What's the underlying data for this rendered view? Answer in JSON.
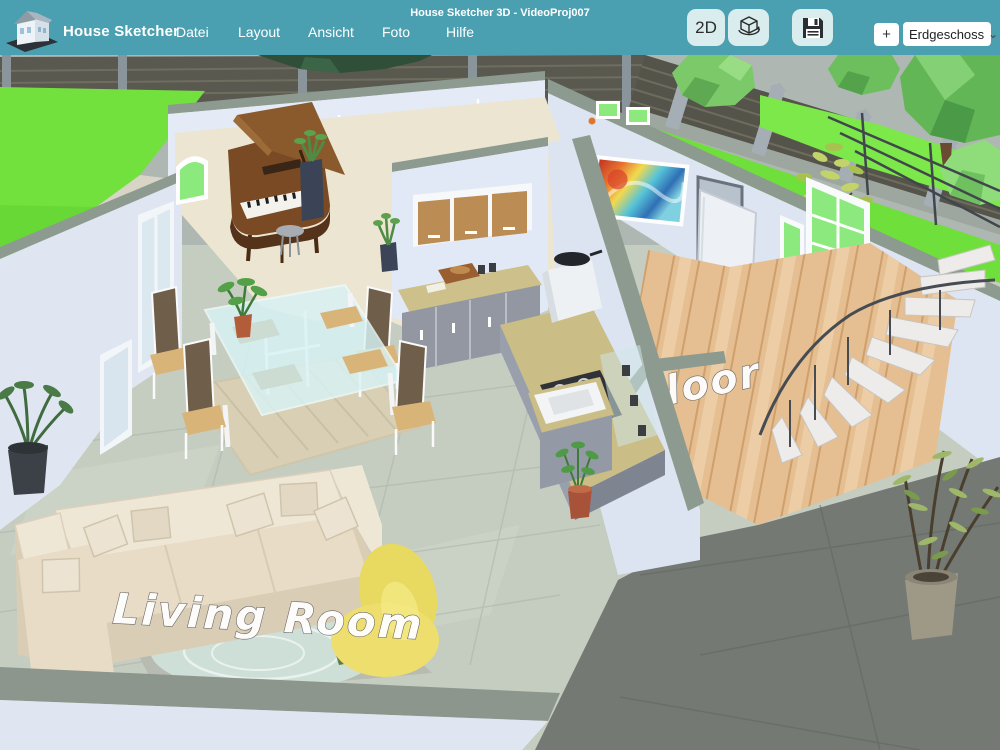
{
  "app": {
    "brand": "House Sketcher",
    "window_title": "House Sketcher 3D - VideoProj007",
    "menu": [
      "Datei",
      "Layout",
      "Ansicht",
      "Foto",
      "Hilfe"
    ],
    "toolbar": {
      "btn_2d": "2D",
      "add_floor_label": "+",
      "floor_selector_value": "Erdgeschoss"
    },
    "icons": {
      "chevron": "⌄",
      "view_cube": "3d-view-cube-icon",
      "save": "save-floppy-icon",
      "logo": "house-logo-icon"
    },
    "colors": {
      "topbar": "#4AA0B1",
      "button_bg": "#D9EDEE",
      "wall": "#DFE7F4",
      "wall_top": "#8D9A90",
      "grass": "#72E13D",
      "tile_floor": "#C5CDC1",
      "wood_floor": "#E5BF92",
      "dark_floor": "#747974",
      "sofa": "#EAE0CB",
      "bean_bag": "#EBDC66"
    }
  },
  "scene": {
    "labels": {
      "living_room": "Living Room",
      "floor": "Floor"
    }
  }
}
